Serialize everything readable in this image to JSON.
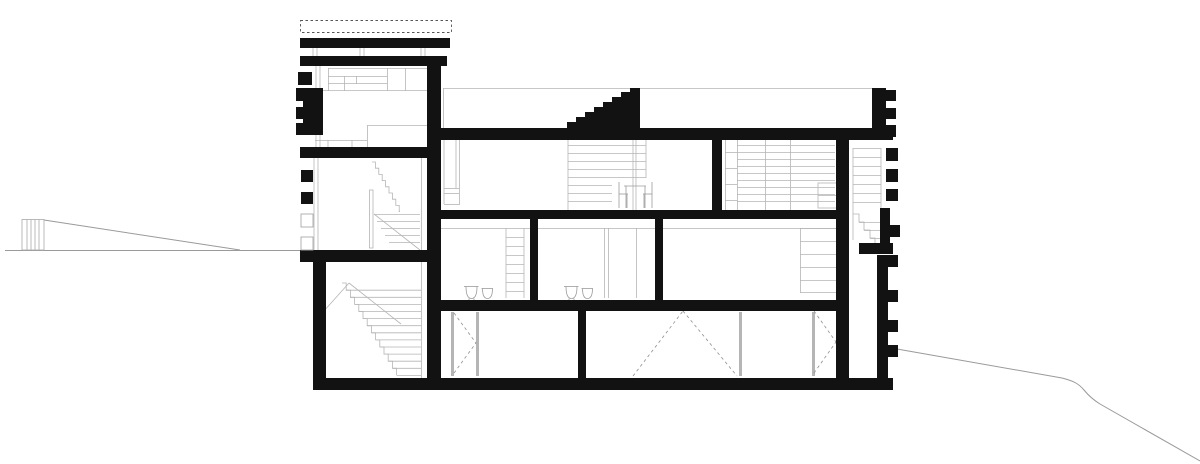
{
  "meta": {
    "title": "Architectural cross-section drawing",
    "drawing_type": "building section, black poche on white",
    "visible_text": "none"
  },
  "colors": {
    "background": "#ffffff",
    "ink": "#121212",
    "detail_line": "#b5b5b5",
    "furniture_line": "#9b9b9b",
    "ground_line": "#9a9a9a",
    "dashed_line": "#8f8f8f",
    "hatch_outline": "#aaaaaa",
    "parapet_dash": "#555555"
  },
  "parts": [
    "left-ground-line",
    "retaining-post",
    "terrain-slope-left",
    "tower-parapet-dashed",
    "tower-roof-slabs",
    "tower-left-wall-hatch",
    "tower-top-room-cabinets",
    "tower-mid-stair",
    "tower-main-stair",
    "main-roof-slab",
    "roof-stair-black",
    "upper-floor-rooms",
    "shelving-lines",
    "chairs-and-table",
    "interior-walls",
    "ground-floor-rooms",
    "wash-basins",
    "ladder-shelf",
    "basement-rooms",
    "door-swing-dashes",
    "right-facade-hatch",
    "exterior-stair-right",
    "terrain-slope-right",
    "base-slab"
  ]
}
